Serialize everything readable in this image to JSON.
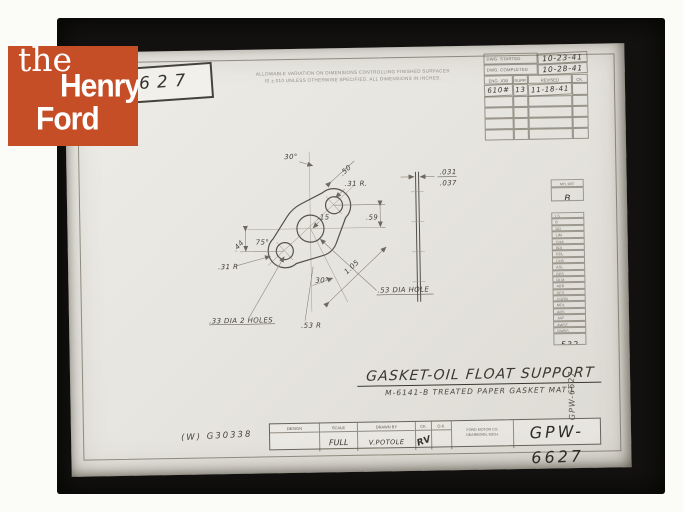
{
  "colors": {
    "logo_bg": "#C64E27",
    "frame": "#131210",
    "sheet": "#E7E5DF",
    "ink": "#3A372F"
  },
  "logo": {
    "the": "the",
    "henry": "Henry",
    "ford": "Ford"
  },
  "corner_label": "627",
  "tolerance_note": {
    "line1": "ALLOWABLE VARIATION ON DIMENSIONS CONTROLLING FINISHED SURFACES",
    "line2": "IS ±.010 UNLESS OTHERWISE SPECIFIED.  ALL DIMENSIONS IN INCHES."
  },
  "rev_table": {
    "started_label": "DWG. STARTED",
    "started_value": "10-23-41",
    "completed_label": "DWG. COMPLETED",
    "completed_value": "10-28-41",
    "cols": [
      "ENG. JOB",
      "SUPP.",
      "REVISED",
      "CK."
    ],
    "entry": {
      "job": "610#",
      "supp": "13",
      "revised": "11-18-41",
      "ck": ""
    }
  },
  "dist_strip": {
    "header": "MTL OFF",
    "top_value": "B",
    "codes": [
      "LS",
      "B",
      "RR",
      "LIM",
      "CHA",
      "BRL",
      "RDL",
      "CHS",
      "ASL",
      "BPS",
      "RLM",
      "ABB",
      "DES",
      "CGRN",
      "MDL",
      "ABS",
      "JAP",
      "AWST",
      "RWBS"
    ],
    "bottom_value": "532"
  },
  "drawing": {
    "angle_top": "30°",
    "len_upper": ".50",
    "rad_upper": ".31 R.",
    "dim_right": ".59",
    "dim_center": ".15",
    "angle_lower_left": "75°",
    "dim_left": ".44",
    "rad_lower": ".31 R",
    "len_lower": "1.05",
    "angle_bottom": "30°",
    "center_hole": ".53 DIA HOLE",
    "end_holes": ".33 DIA 2 HOLES",
    "rad_middle": ".53 R",
    "thickness_max": ".031",
    "thickness_min": ".037"
  },
  "title": "GASKET-OIL FLOAT SUPPORT",
  "subtitle": "M-6141-B TREATED PAPER GASKET MAT'L",
  "title_block": {
    "design_label": "DESIGN",
    "scale_label": "SCALE",
    "drawn_label": "DRAWN BY",
    "ck_label": "CK.",
    "ok_label": "O.K.",
    "scale_value": "FULL",
    "drawn_value": "V.POTOLE",
    "ck_value": "RV",
    "company_line1": "FORD MOTOR CO.",
    "company_line2": "DEARBORN, MICH.",
    "part_number": "GPW-6627"
  },
  "accession": "(W) G30338",
  "margin_note": "GPW-6627"
}
